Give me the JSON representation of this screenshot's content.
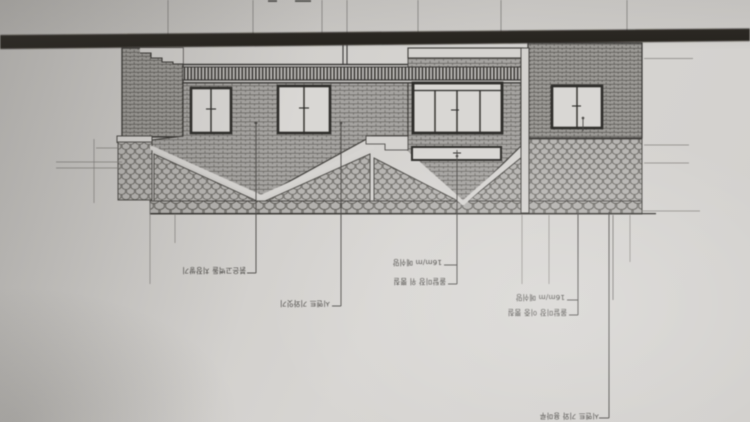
{
  "colors": {
    "paper": "#d2d0cd",
    "dark_band": "#26241f",
    "line": "#3c3a36",
    "brick_fill": "#a6a4a0",
    "brick_dark_fill": "#9c9a95",
    "tile_fill": "#b6b4b0",
    "window_fill": "#d9d7d4",
    "annotation_text": "#413f3b"
  },
  "drawing": {
    "annotations": {
      "brick_note": "붉은고벽돌 치장쌓기",
      "tile_note": "시멘트 기와잇기",
      "left_spec": {
        "line1": "16m/m 메쉬망",
        "line2": "몰탈미장 위 뿜칠"
      },
      "right_spec": {
        "line1": "16m/m 메쉬망",
        "line2": "몰탈미장 이중 뿜칠"
      },
      "bottom_note": "시멘트 기와 용마루"
    }
  }
}
